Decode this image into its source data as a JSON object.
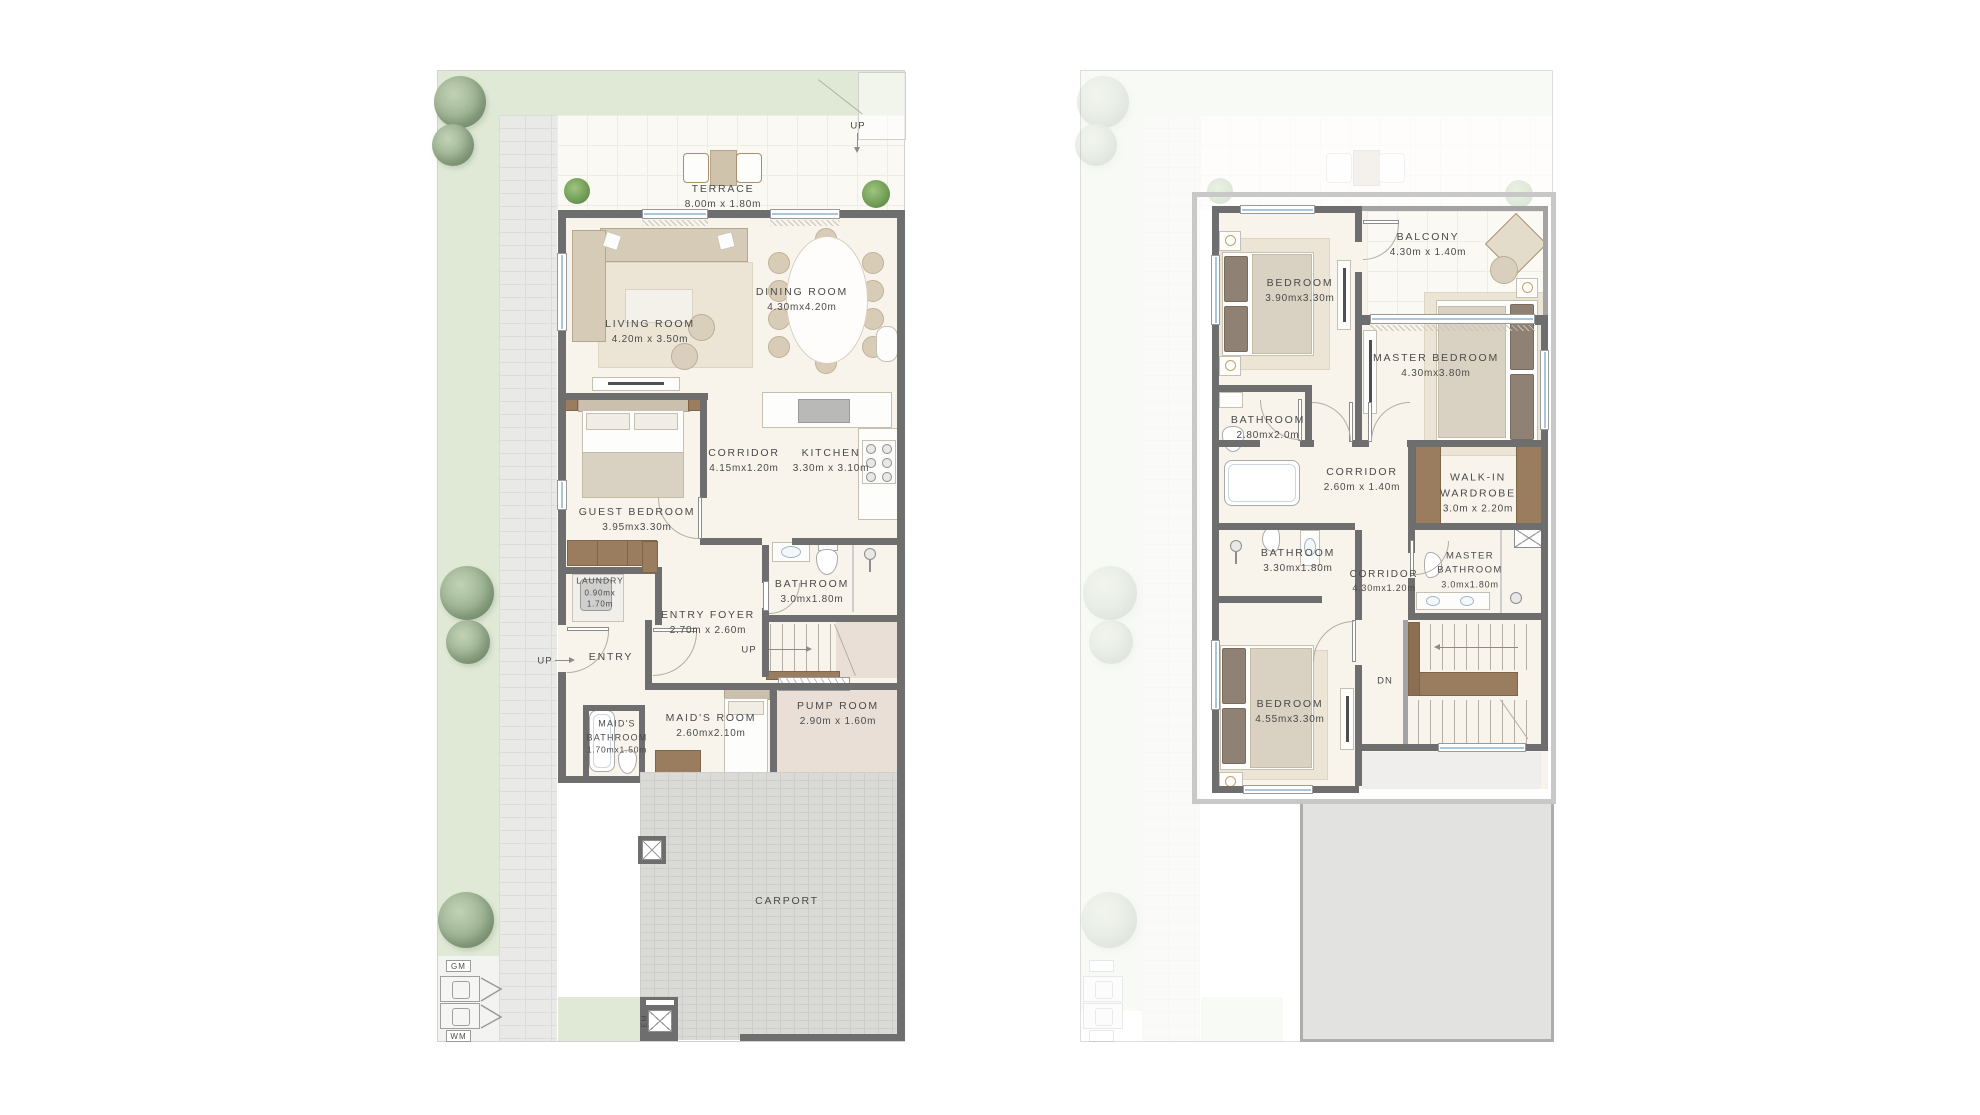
{
  "document": {
    "type": "floor-plan",
    "panels": [
      "ground-floor",
      "first-floor"
    ]
  },
  "colors": {
    "wall": "#6e6e6e",
    "grass": "#e0e9d6",
    "window_glass": "#a9c6da",
    "floor": "#f8f4ec",
    "wood": "#9a7d5f",
    "carport": "#dadad7",
    "pump_floor": "#eadfd7",
    "label_text": "#4a4a4a",
    "roof_outline": "#c8c8c8"
  },
  "ground_floor": {
    "rooms": {
      "terrace": {
        "name": "TERRACE",
        "dims": "8.00m x 1.80m"
      },
      "living": {
        "name": "LIVING ROOM",
        "dims": "4.20m x 3.50m"
      },
      "dining": {
        "name": "DINING ROOM",
        "dims": "4.30mx4.20m"
      },
      "corridor": {
        "name": "CORRIDOR",
        "dims": "4.15mx1.20m"
      },
      "kitchen": {
        "name": "KITCHEN",
        "dims": "3.30m x 3.10m"
      },
      "guest_bedroom": {
        "name": "GUEST BEDROOM",
        "dims": "3.95mx3.30m"
      },
      "laundry": {
        "name": "LAUNDRY",
        "dims": "0.90mx 1.70m"
      },
      "bathroom": {
        "name": "BATHROOM",
        "dims": "3.0mx1.80m"
      },
      "entry_foyer": {
        "name": "ENTRY FOYER",
        "dims": "2.70m x 2.60m"
      },
      "entry": {
        "name": "ENTRY"
      },
      "maids_room": {
        "name": "MAID'S ROOM",
        "dims": "2.60mx2.10m"
      },
      "maids_bathroom": {
        "name": "MAID'S BATHROOM",
        "dims": "1.70mx1.50m"
      },
      "pump_room": {
        "name": "PUMP ROOM",
        "dims": "2.90m x 1.60m"
      },
      "carport": {
        "name": "CARPORT"
      }
    },
    "markers": {
      "up_gate": "UP",
      "up_entry": "UP",
      "up_stairs": "UP",
      "gm": "GM",
      "wm": "WM",
      "em": "EM"
    }
  },
  "first_floor": {
    "rooms": {
      "bedroom_top": {
        "name": "BEDROOM",
        "dims": "3.90mx3.30m"
      },
      "balcony": {
        "name": "BALCONY",
        "dims": "4.30m x 1.40m"
      },
      "master_bedroom": {
        "name": "MASTER BEDROOM",
        "dims": "4.30mx3.80m"
      },
      "bathroom_top": {
        "name": "BATHROOM",
        "dims": "2.80mx2.0m"
      },
      "corridor_upper": {
        "name": "CORRIDOR",
        "dims": "2.60m x 1.40m"
      },
      "walkin_wardrobe": {
        "name": "WALK-IN WARDROBE",
        "dims": "3.0m x 2.20m"
      },
      "bathroom_mid": {
        "name": "BATHROOM",
        "dims": "3.30mx1.80m"
      },
      "corridor_main": {
        "name": "CORRIDOR",
        "dims": "4.30mx1.20m"
      },
      "master_bathroom": {
        "name": "MASTER BATHROOM",
        "dims": "3.0mx1.80m"
      },
      "bedroom_bottom": {
        "name": "BEDROOM",
        "dims": "4.55mx3.30m"
      }
    },
    "markers": {
      "dn": "DN"
    }
  }
}
